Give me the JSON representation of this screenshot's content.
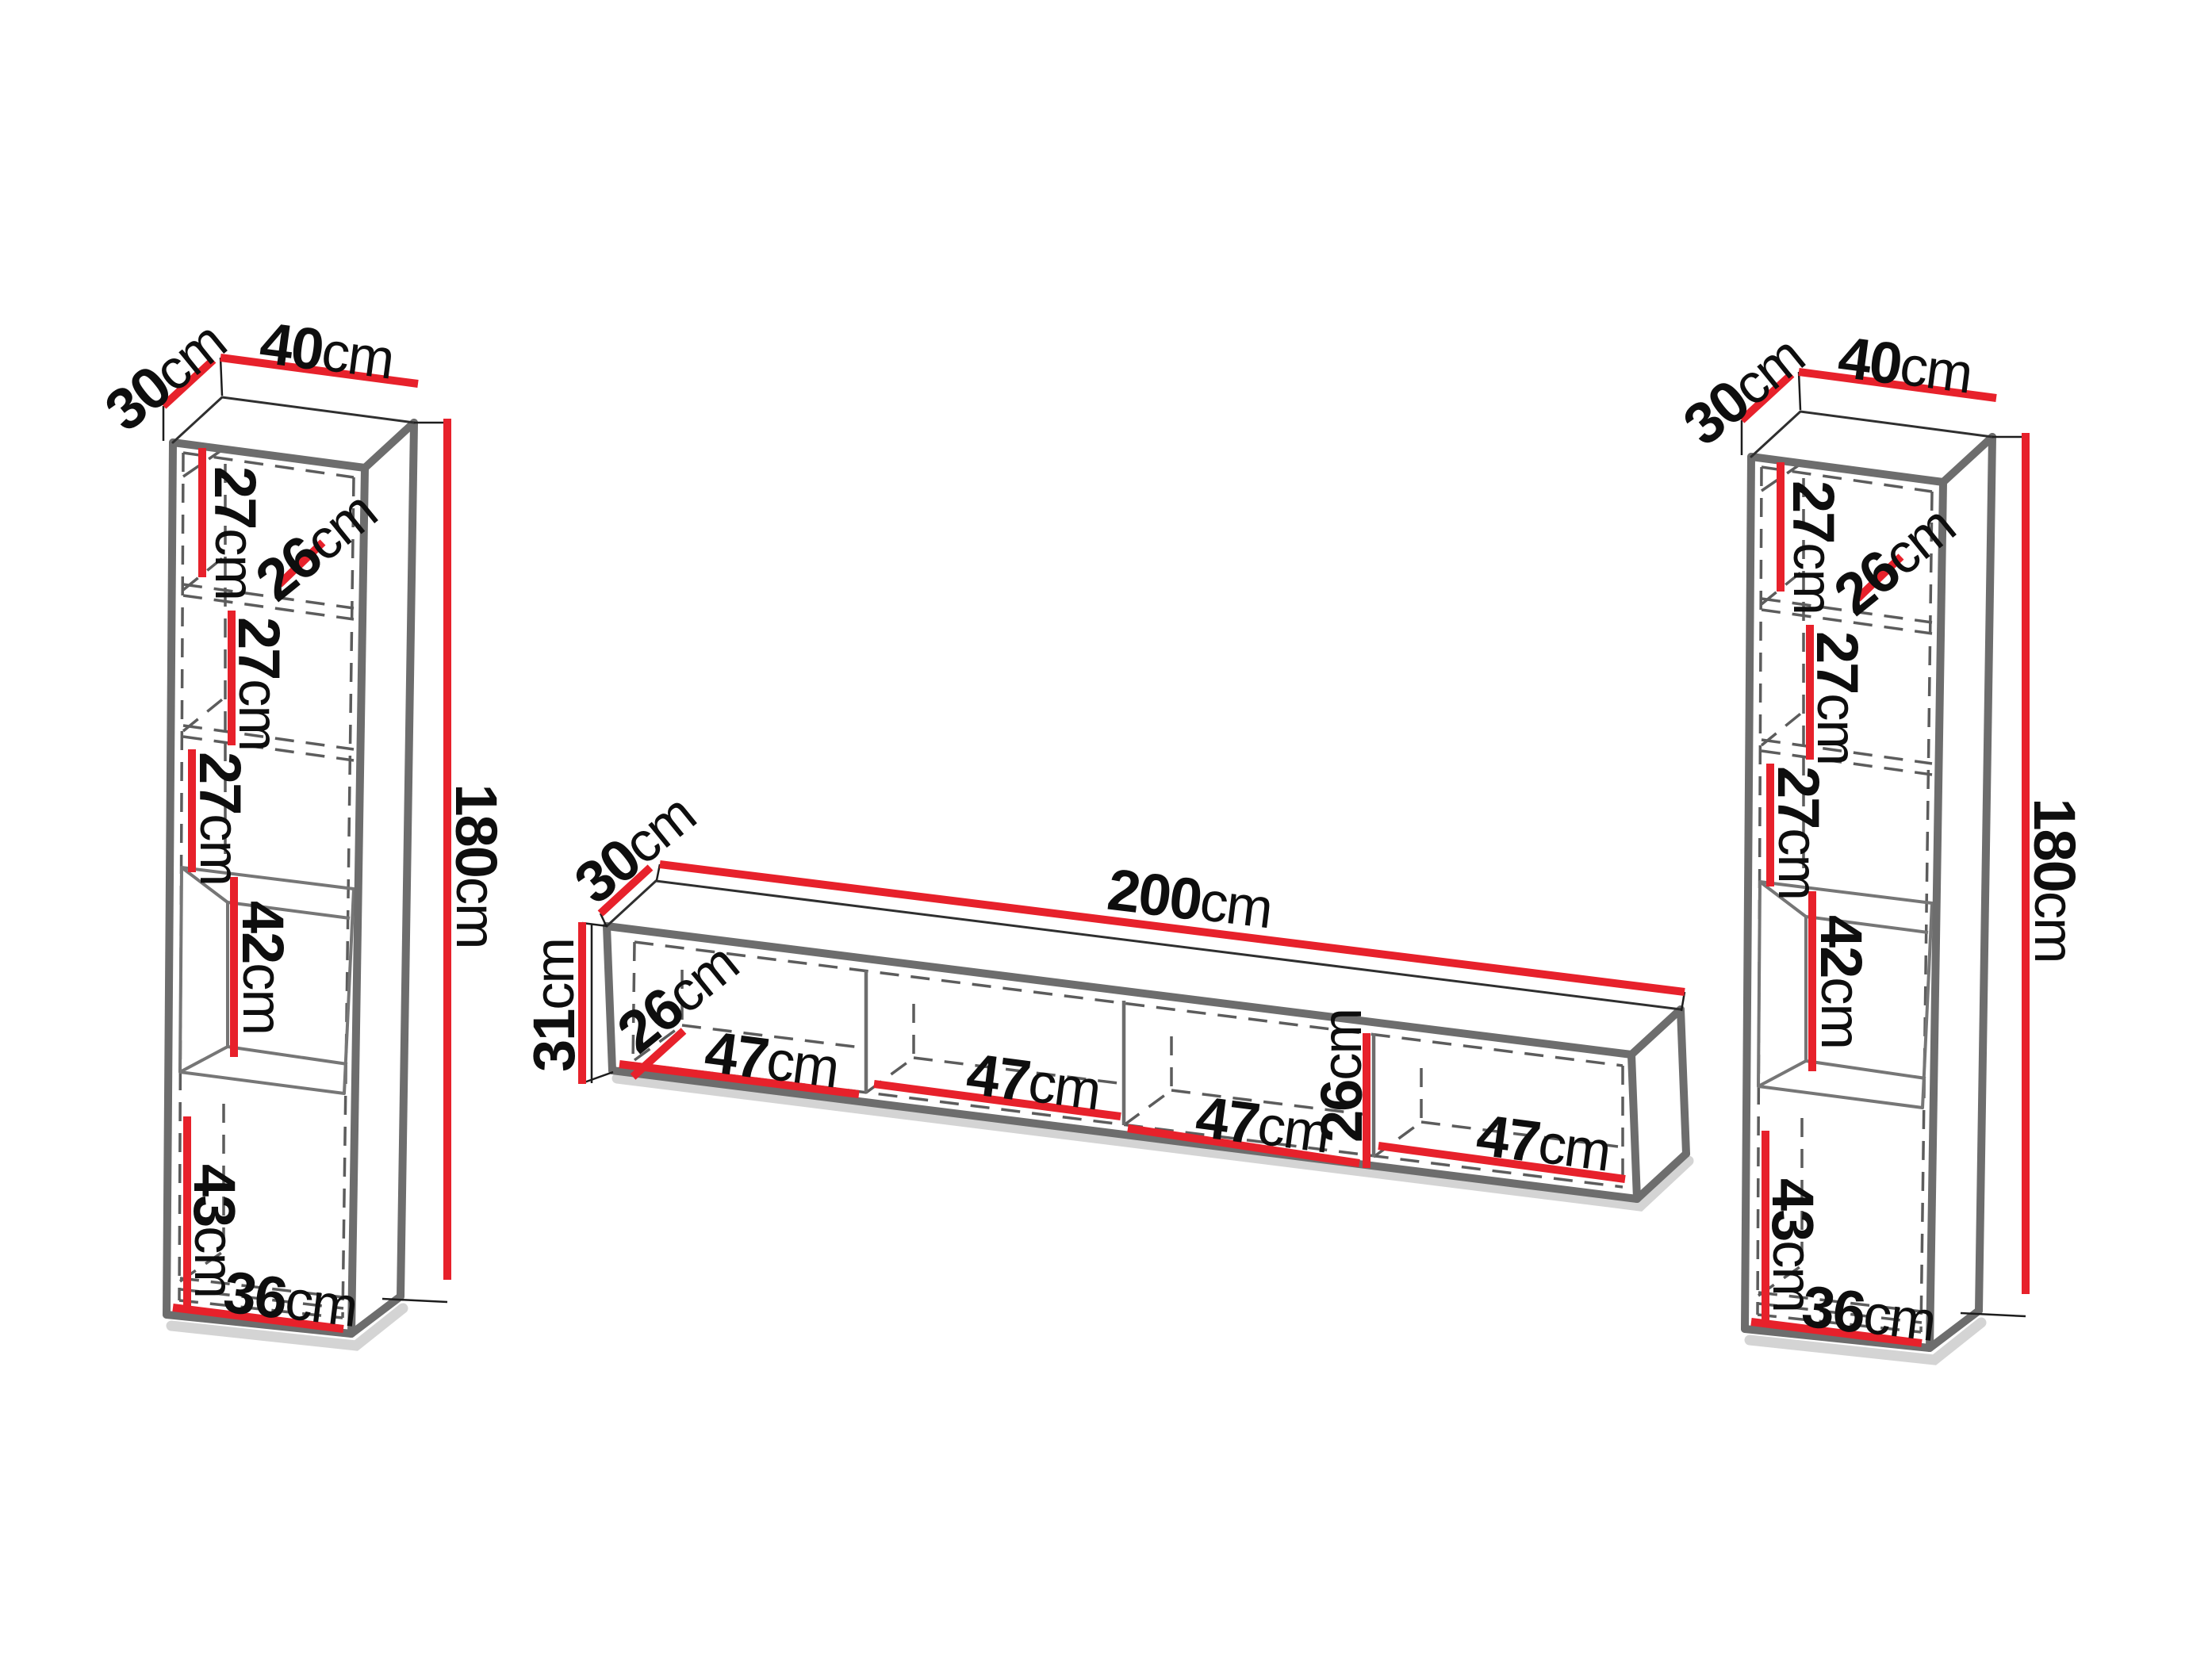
{
  "diagram_type": "furniture dimension drawing",
  "accent_color": "#e7212b",
  "outline_color": "#6d6d6d",
  "left_cabinet": {
    "depth": {
      "value": "30",
      "unit": "cm"
    },
    "width": {
      "value": "40",
      "unit": "cm"
    },
    "height": {
      "value": "180",
      "unit": "cm"
    },
    "top_shelf": {
      "value": "27",
      "unit": "cm"
    },
    "top_opening": {
      "value": "26",
      "unit": "cm"
    },
    "second_shelf": {
      "value": "27",
      "unit": "cm"
    },
    "third_shelf": {
      "value": "27",
      "unit": "cm"
    },
    "open_niche": {
      "value": "42",
      "unit": "cm"
    },
    "bottom_compartment": {
      "value": "43",
      "unit": "cm"
    },
    "inner_width": {
      "value": "36",
      "unit": "cm"
    }
  },
  "tv_stand": {
    "depth": {
      "value": "30",
      "unit": "cm"
    },
    "width": {
      "value": "200",
      "unit": "cm"
    },
    "height": {
      "value": "31",
      "unit": "cm"
    },
    "opening_height_left": {
      "value": "26",
      "unit": "cm"
    },
    "opening_height_right": {
      "value": "26",
      "unit": "cm"
    },
    "compartments": [
      {
        "value": "47",
        "unit": "cm"
      },
      {
        "value": "47",
        "unit": "cm"
      },
      {
        "value": "47",
        "unit": "cm"
      },
      {
        "value": "47",
        "unit": "cm"
      }
    ]
  },
  "right_cabinet": {
    "depth": {
      "value": "30",
      "unit": "cm"
    },
    "width": {
      "value": "40",
      "unit": "cm"
    },
    "height": {
      "value": "180",
      "unit": "cm"
    },
    "top_shelf": {
      "value": "27",
      "unit": "cm"
    },
    "top_opening": {
      "value": "26",
      "unit": "cm"
    },
    "second_shelf": {
      "value": "27",
      "unit": "cm"
    },
    "third_shelf": {
      "value": "27",
      "unit": "cm"
    },
    "open_niche": {
      "value": "42",
      "unit": "cm"
    },
    "bottom_compartment": {
      "value": "43",
      "unit": "cm"
    },
    "inner_width": {
      "value": "36",
      "unit": "cm"
    }
  }
}
